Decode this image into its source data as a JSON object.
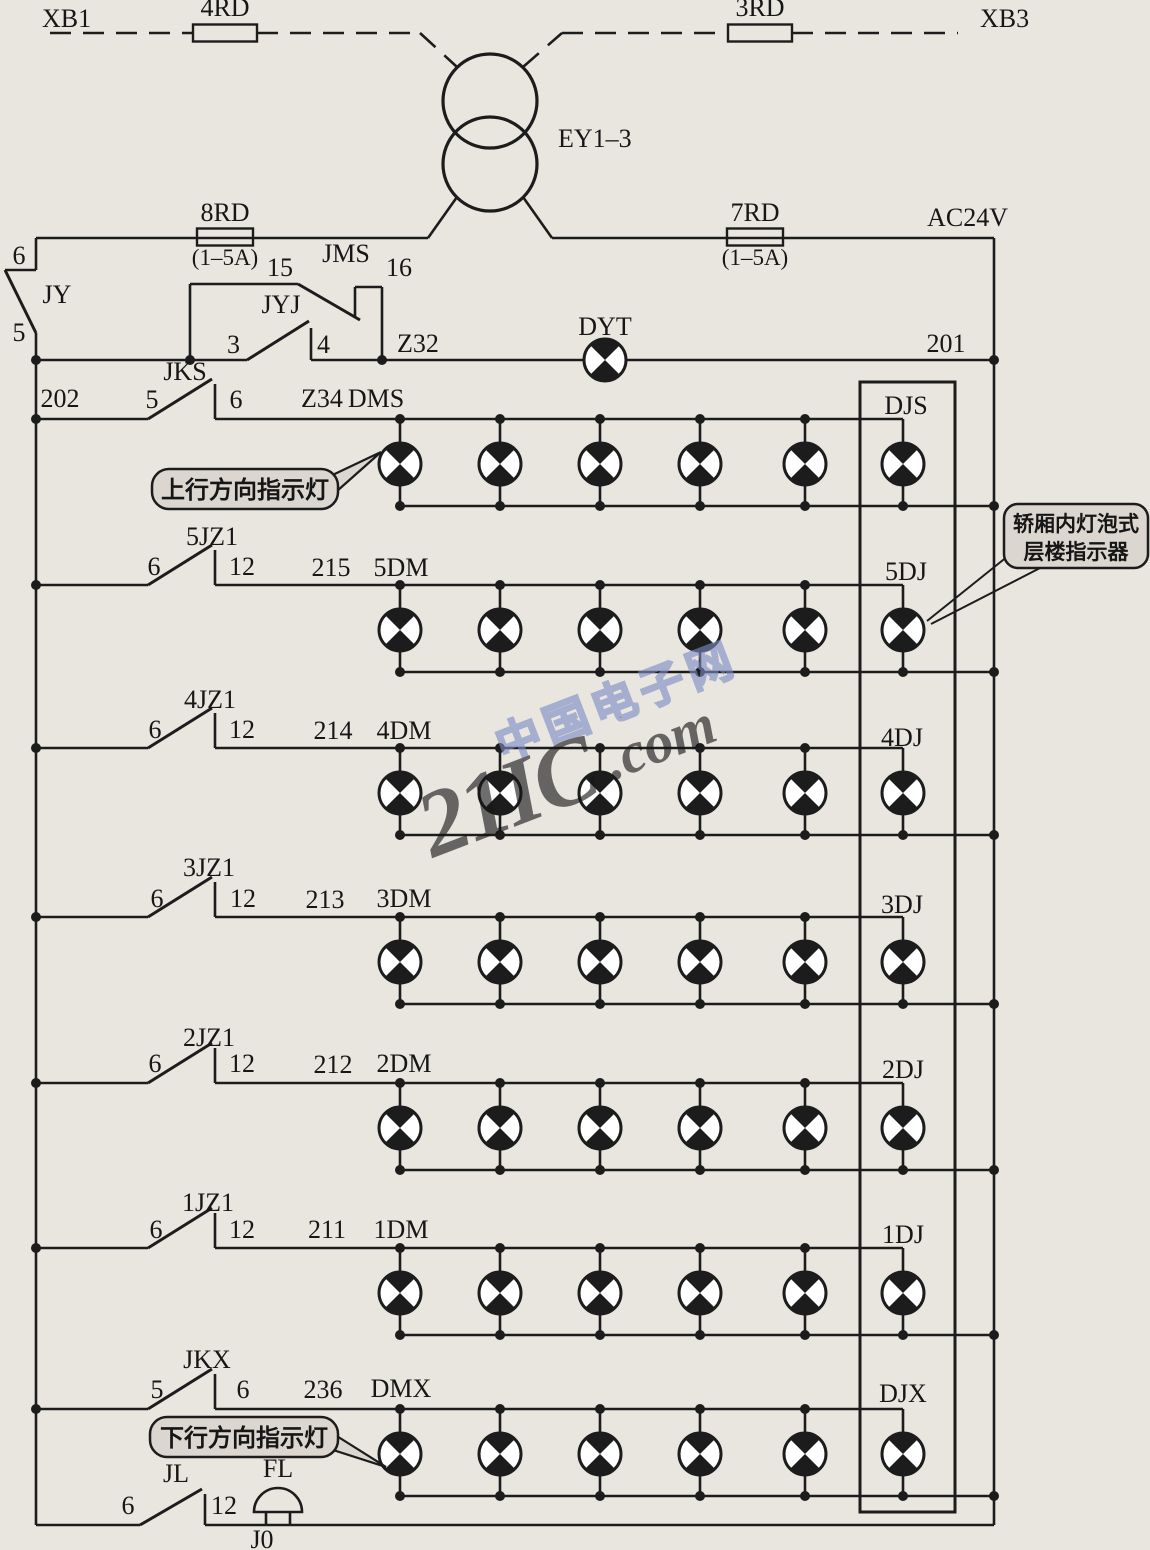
{
  "diagram": {
    "top": {
      "terminal_left": "XB1",
      "fuse_left": "4RD",
      "fuse_right": "3RD",
      "terminal_right": "XB3",
      "transformer": "EY1–3"
    },
    "supply": {
      "fuse_left": "8RD",
      "fuse_left_rating": "(1–5A)",
      "fuse_right": "7RD",
      "fuse_right_rating": "(1–5A)",
      "voltage": "AC24V"
    },
    "control": {
      "jy": {
        "label": "JY",
        "top_num": "6",
        "bottom_num": "5"
      },
      "jms": {
        "label": "JMS",
        "left_num": "15",
        "right_num": "16"
      },
      "jyj": {
        "label": "JYJ",
        "left_num": "3",
        "right_num": "4"
      },
      "dyt_label": "DYT",
      "wire_z32": "Z32",
      "wire_201": "201",
      "wire_202": "202"
    },
    "rows": [
      {
        "switch_label": "JKS",
        "left_num": "5",
        "right_num": "6",
        "wire_num": "Z34",
        "line_label": "DMS",
        "dj_label": "DJS"
      },
      {
        "switch_label": "5JZ1",
        "left_num": "6",
        "right_num": "12",
        "wire_num": "215",
        "line_label": "5DM",
        "dj_label": "5DJ"
      },
      {
        "switch_label": "4JZ1",
        "left_num": "6",
        "right_num": "12",
        "wire_num": "214",
        "line_label": "4DM",
        "dj_label": "4DJ"
      },
      {
        "switch_label": "3JZ1",
        "left_num": "6",
        "right_num": "12",
        "wire_num": "213",
        "line_label": "3DM",
        "dj_label": "3DJ"
      },
      {
        "switch_label": "2JZ1",
        "left_num": "6",
        "right_num": "12",
        "wire_num": "212",
        "line_label": "2DM",
        "dj_label": "2DJ"
      },
      {
        "switch_label": "1JZ1",
        "left_num": "6",
        "right_num": "12",
        "wire_num": "211",
        "line_label": "1DM",
        "dj_label": "1DJ"
      },
      {
        "switch_label": "JKX",
        "left_num": "5",
        "right_num": "6",
        "wire_num": "236",
        "line_label": "DMX",
        "dj_label": "DJX"
      }
    ],
    "bottom": {
      "switch_label": "JL",
      "left_num": "6",
      "right_num": "12",
      "bell_label": "FL",
      "wire_num": "J0"
    },
    "callouts": {
      "up": "上行方向指示灯",
      "down": "下行方向指示灯",
      "right_line1": "轿厢内灯泡式",
      "right_line2": "层楼指示器"
    },
    "watermark": {
      "brand": "21IC",
      "suffix": ".com",
      "site": "中国电子网"
    },
    "colors": {
      "ink": "#1c1c1c",
      "paper": "#e9e6e0",
      "watermark_pink": "#e0808e",
      "watermark_blue": "#7d8cc4",
      "callout_fill": "#dbd7d0"
    }
  }
}
